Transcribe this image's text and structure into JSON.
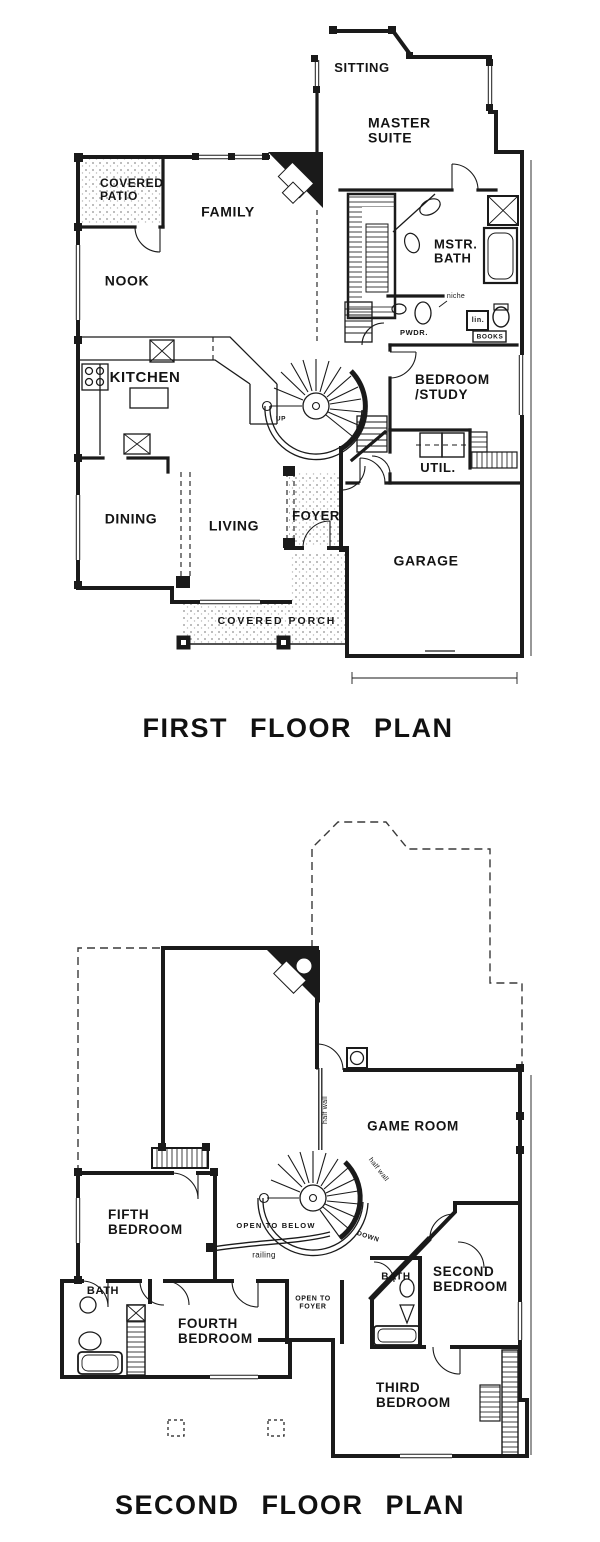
{
  "colors": {
    "ink": "#1a1a1a",
    "paper": "#ffffff",
    "stipple_dot": "#8f8f8f"
  },
  "first_floor": {
    "title": "FIRST FLOOR PLAN",
    "labels": [
      {
        "id": "sitting",
        "text": "SITTING"
      },
      {
        "id": "master-suite",
        "text": "MASTER\nSUITE"
      },
      {
        "id": "covered-patio",
        "text": "COVERED\nPATIO"
      },
      {
        "id": "family",
        "text": "FAMILY"
      },
      {
        "id": "mstr-bath",
        "text": "MSTR.\nBATH"
      },
      {
        "id": "nook",
        "text": "NOOK"
      },
      {
        "id": "niche",
        "text": "niche"
      },
      {
        "id": "pwdr",
        "text": "PWDR."
      },
      {
        "id": "lin",
        "text": "lin."
      },
      {
        "id": "books",
        "text": "BOOKS"
      },
      {
        "id": "kitchen",
        "text": "KITCHEN"
      },
      {
        "id": "bedroom-study",
        "text": "BEDROOM\n/STUDY"
      },
      {
        "id": "up",
        "text": "UP"
      },
      {
        "id": "util",
        "text": "UTIL."
      },
      {
        "id": "dining",
        "text": "DINING"
      },
      {
        "id": "living",
        "text": "LIVING"
      },
      {
        "id": "foyer",
        "text": "FOYER"
      },
      {
        "id": "garage",
        "text": "GARAGE"
      },
      {
        "id": "covered-porch",
        "text": "COVERED  PORCH"
      }
    ]
  },
  "second_floor": {
    "title": "SECOND FLOOR PLAN",
    "labels": [
      {
        "id": "game-room",
        "text": "GAME  ROOM"
      },
      {
        "id": "half-wall-vertical",
        "text": "half wall"
      },
      {
        "id": "half-wall-diagonal",
        "text": "half wall"
      },
      {
        "id": "open-to-below",
        "text": "OPEN TO BELOW"
      },
      {
        "id": "railing",
        "text": "railing"
      },
      {
        "id": "down",
        "text": "DOWN"
      },
      {
        "id": "fifth-bedroom",
        "text": "FIFTH\nBEDROOM"
      },
      {
        "id": "bath-left",
        "text": "BATH"
      },
      {
        "id": "open-to-foyer",
        "text": "OPEN TO\nFOYER"
      },
      {
        "id": "fourth-bedroom",
        "text": "FOURTH\nBEDROOM"
      },
      {
        "id": "bath-right",
        "text": "BATH"
      },
      {
        "id": "second-bedroom",
        "text": "SECOND\nBEDROOM"
      },
      {
        "id": "third-bedroom",
        "text": "THIRD\nBEDROOM"
      }
    ]
  }
}
